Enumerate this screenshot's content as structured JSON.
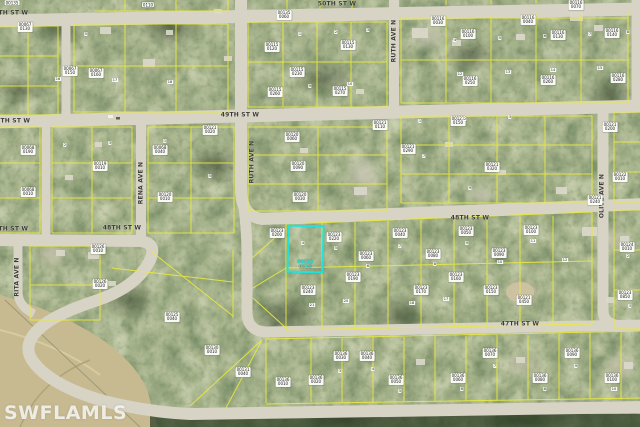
{
  "map": {
    "watermark": "SWFLAMLS",
    "highlighted_parcel": {
      "id_lines": [
        "00123",
        "0210"
      ],
      "outline_color": "#1fe2de"
    },
    "colors": {
      "road": "#d7d3c5",
      "parcel_line": "#eaea3e",
      "highlight": "#1fe2de",
      "vegetation_dark": "#2e4024",
      "vegetation_light": "#9aa77c",
      "field": "#c7ba90"
    },
    "street_labels": [
      [
        "50TH ST W",
        9,
        13,
        0
      ],
      [
        "50TH ST W",
        337,
        4,
        0
      ],
      [
        "49TH ST W",
        11,
        121,
        0
      ],
      [
        "49TH ST W",
        240,
        115,
        0
      ],
      [
        "48TH ST W",
        9,
        229,
        0
      ],
      [
        "48TH ST W",
        122,
        228,
        0
      ],
      [
        "48TH ST W",
        470,
        218,
        0
      ],
      [
        "47TH ST W",
        520,
        324,
        0
      ],
      [
        "RENA AVE N",
        141,
        183,
        -90
      ],
      [
        "RUTH AVE N",
        252,
        162,
        -90
      ],
      [
        "RUTH AVE N",
        394,
        41,
        -90
      ],
      [
        "OLIVE AVE N",
        602,
        196,
        -90
      ],
      [
        "RITA AVE N",
        17,
        277,
        -90
      ]
    ],
    "parcel_labels": [
      [
        12,
        3,
        "00135"
      ],
      [
        148,
        5,
        "0110"
      ],
      [
        25,
        27,
        "00067",
        "0130"
      ],
      [
        70,
        71,
        "00067",
        "0150"
      ],
      [
        96,
        73,
        "00067",
        "0160"
      ],
      [
        160,
        150,
        "00068",
        "0040"
      ],
      [
        28,
        150,
        "00068",
        "0190"
      ],
      [
        28,
        192,
        "00068",
        "0010"
      ],
      [
        100,
        166,
        "00119",
        "0010"
      ],
      [
        165,
        197,
        "00120",
        "0010"
      ],
      [
        284,
        15,
        "00135",
        "0060"
      ],
      [
        272,
        47,
        "00115",
        "0120"
      ],
      [
        348,
        45,
        "00115",
        "0130"
      ],
      [
        297,
        72,
        "00115",
        "0230"
      ],
      [
        275,
        92,
        "00115",
        "0260"
      ],
      [
        340,
        91,
        "00115",
        "0270"
      ],
      [
        438,
        21,
        "00116",
        "0030"
      ],
      [
        528,
        20,
        "00116",
        "0040"
      ],
      [
        576,
        5,
        "00116",
        "0070"
      ],
      [
        468,
        34,
        "00116",
        "0100"
      ],
      [
        558,
        35,
        "00116",
        "0130"
      ],
      [
        612,
        33,
        "00116",
        "0140"
      ],
      [
        470,
        81,
        "00116",
        "0250"
      ],
      [
        548,
        80,
        "00116",
        "0260"
      ],
      [
        618,
        78,
        "00116",
        "0280"
      ],
      [
        210,
        130,
        "00121",
        "0020"
      ],
      [
        292,
        137,
        "00120",
        "0060"
      ],
      [
        298,
        166,
        "00120",
        "0090"
      ],
      [
        300,
        197,
        "00120",
        "0030"
      ],
      [
        380,
        125,
        "00121",
        "0110"
      ],
      [
        458,
        121,
        "00121",
        "0150"
      ],
      [
        610,
        127,
        "00121",
        "0200"
      ],
      [
        408,
        149,
        "00121",
        "0290"
      ],
      [
        492,
        167,
        "00121",
        "0320"
      ],
      [
        595,
        200,
        "00121",
        "0240"
      ],
      [
        620,
        177,
        "00122",
        "0010"
      ],
      [
        277,
        233,
        "00123",
        "0200"
      ],
      [
        334,
        237,
        "00123",
        "0220"
      ],
      [
        400,
        233,
        "00123",
        "0040"
      ],
      [
        366,
        256,
        "00123",
        "0060"
      ],
      [
        433,
        254,
        "00123",
        "0080"
      ],
      [
        466,
        231,
        "00123",
        "0050"
      ],
      [
        499,
        253,
        "00123",
        "0090"
      ],
      [
        531,
        230,
        "00123",
        "0100"
      ],
      [
        308,
        290,
        "00123",
        "0240"
      ],
      [
        353,
        277,
        "00123",
        "0190"
      ],
      [
        421,
        290,
        "00123",
        "0170"
      ],
      [
        456,
        277,
        "00123",
        "0160"
      ],
      [
        491,
        290,
        "00123",
        "0150"
      ],
      [
        524,
        300,
        "00121",
        "0450"
      ],
      [
        172,
        317,
        "00125",
        "0040"
      ],
      [
        98,
        249,
        "00126",
        "0010"
      ],
      [
        100,
        284,
        "00126",
        "0020"
      ],
      [
        627,
        247,
        "00124",
        "0010"
      ],
      [
        625,
        295,
        "00123",
        "0850"
      ],
      [
        283,
        382,
        "00136",
        "0010"
      ],
      [
        316,
        380,
        "00136",
        "0020"
      ],
      [
        341,
        356,
        "00136",
        "0030"
      ],
      [
        367,
        356,
        "00136",
        "0040"
      ],
      [
        396,
        380,
        "00136",
        "0050"
      ],
      [
        458,
        378,
        "00136",
        "0060"
      ],
      [
        490,
        353,
        "00136",
        "0070"
      ],
      [
        540,
        378,
        "00136",
        "0080"
      ],
      [
        572,
        353,
        "00136",
        "0090"
      ],
      [
        612,
        378,
        "00136",
        "0100"
      ],
      [
        212,
        350,
        "00130",
        "0010"
      ],
      [
        243,
        372,
        "00131",
        "0040"
      ]
    ],
    "lot_numbers": [
      [
        86,
        34,
        "5"
      ],
      [
        58,
        79,
        "16"
      ],
      [
        115,
        80,
        "17"
      ],
      [
        170,
        82,
        "18"
      ],
      [
        300,
        34,
        "1"
      ],
      [
        336,
        32,
        "2"
      ],
      [
        368,
        30,
        "3"
      ],
      [
        455,
        40,
        "4"
      ],
      [
        500,
        38,
        "5"
      ],
      [
        545,
        36,
        "6"
      ],
      [
        590,
        34,
        "7"
      ],
      [
        628,
        32,
        "8"
      ],
      [
        310,
        86,
        "9"
      ],
      [
        350,
        84,
        "10"
      ],
      [
        460,
        74,
        "12"
      ],
      [
        508,
        72,
        "13"
      ],
      [
        553,
        70,
        "14"
      ],
      [
        600,
        68,
        "15"
      ],
      [
        65,
        145,
        "2"
      ],
      [
        110,
        143,
        "3"
      ],
      [
        165,
        141,
        "1"
      ],
      [
        210,
        176,
        "5"
      ],
      [
        420,
        121,
        "1"
      ],
      [
        465,
        119,
        "2"
      ],
      [
        510,
        117,
        "3"
      ],
      [
        424,
        156,
        "7"
      ],
      [
        470,
        188,
        "9"
      ],
      [
        303,
        243,
        "4"
      ],
      [
        336,
        248,
        "5"
      ],
      [
        368,
        266,
        "6"
      ],
      [
        400,
        246,
        "7"
      ],
      [
        435,
        264,
        "8"
      ],
      [
        467,
        243,
        "9"
      ],
      [
        500,
        262,
        "10"
      ],
      [
        533,
        241,
        "11"
      ],
      [
        565,
        260,
        "12"
      ],
      [
        312,
        305,
        "21"
      ],
      [
        346,
        301,
        "20"
      ],
      [
        412,
        303,
        "18"
      ],
      [
        446,
        299,
        "17"
      ],
      [
        340,
        371,
        "3"
      ],
      [
        373,
        369,
        "4"
      ],
      [
        400,
        391,
        "5"
      ],
      [
        462,
        389,
        "6"
      ],
      [
        495,
        366,
        "7"
      ],
      [
        545,
        389,
        "8"
      ],
      [
        576,
        366,
        "9"
      ],
      [
        614,
        389,
        "10"
      ],
      [
        628,
        256,
        "2"
      ],
      [
        630,
        306,
        "3"
      ]
    ]
  }
}
